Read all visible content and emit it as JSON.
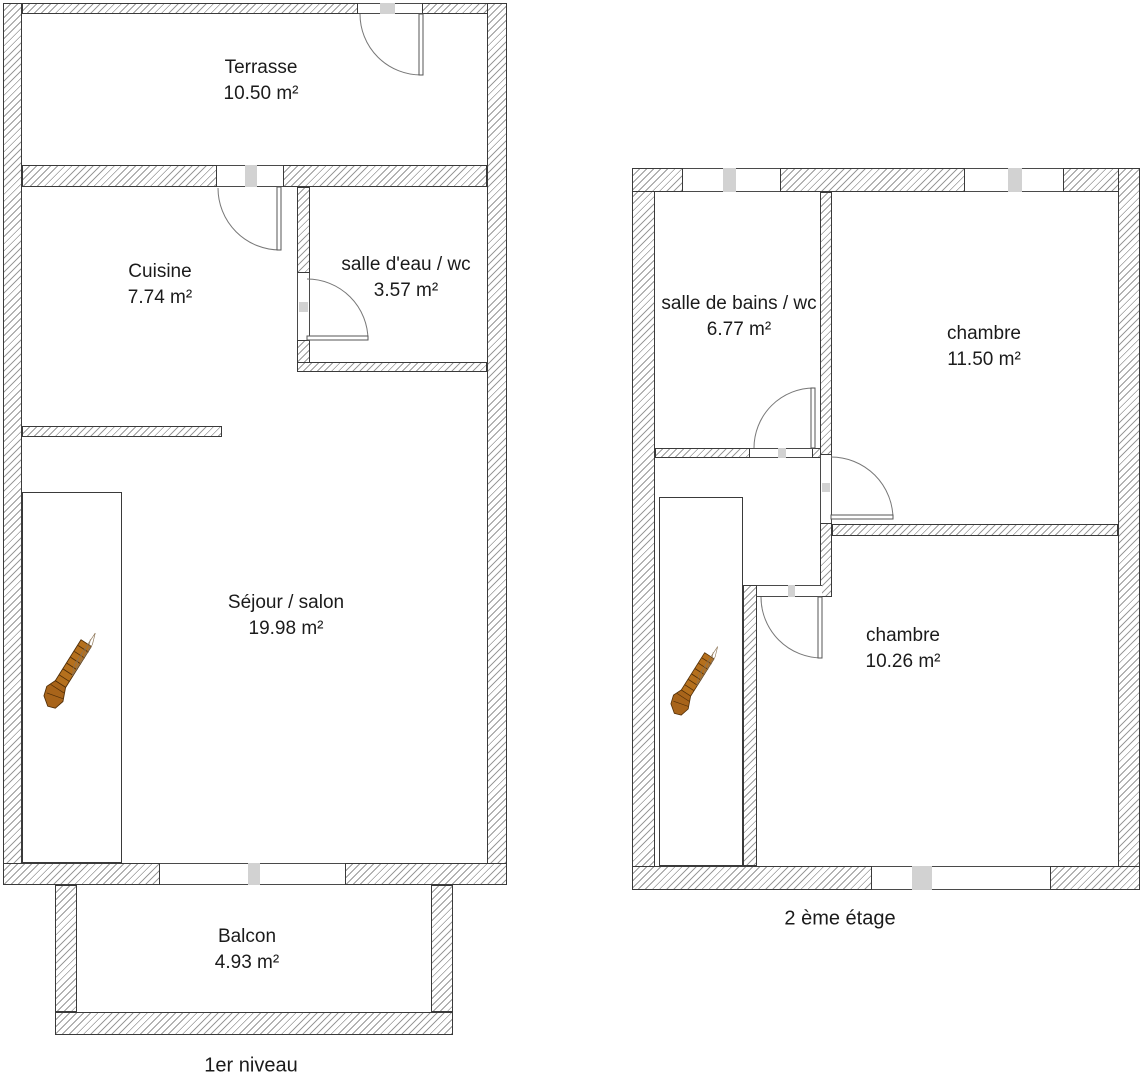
{
  "plans": {
    "first_level": {
      "caption": "1er niveau",
      "rooms": {
        "terrasse": {
          "name": "Terrasse",
          "area": "10.50 m²"
        },
        "cuisine": {
          "name": "Cuisine",
          "area": "7.74 m²"
        },
        "salle_eau_wc": {
          "name": "salle d'eau / wc",
          "area": "3.57 m²"
        },
        "sejour_salon": {
          "name": "Séjour / salon",
          "area": "19.98 m²"
        },
        "balcon": {
          "name": "Balcon",
          "area": "4.93 m²"
        }
      }
    },
    "second_floor": {
      "caption": "2 ème étage",
      "rooms": {
        "salle_bains_wc": {
          "name": "salle de bains / wc",
          "area": "6.77 m²"
        },
        "chambre_grande": {
          "name": "chambre",
          "area": "11.50 m²"
        },
        "chambre_petite": {
          "name": "chambre",
          "area": "10.26 m²"
        }
      }
    }
  },
  "colors": {
    "wall_hatch_line": "#9a9a9a",
    "wall_border": "#3a3a3a",
    "door_marker": "#d2d2d2",
    "stairs_wood": "#b5701d",
    "text": "#1b1b1b",
    "bg": "#ffffff"
  }
}
